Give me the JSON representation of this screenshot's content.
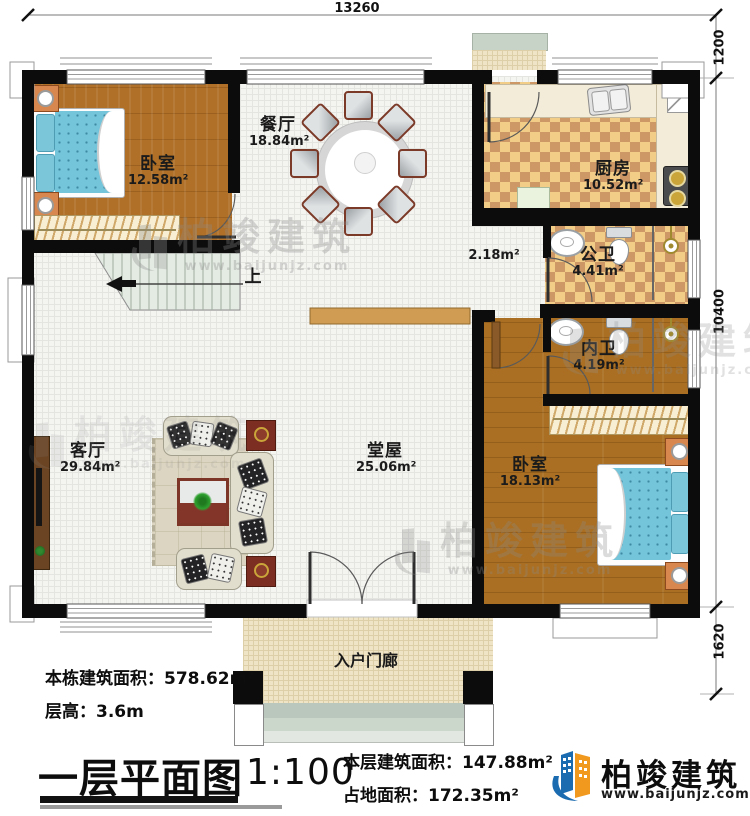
{
  "dimensions": {
    "top": "13260",
    "right_upper": "1200",
    "right_middle": "10400",
    "right_lower": "1620"
  },
  "rooms": {
    "bedroom_top": {
      "name": "卧室",
      "area": "12.58m²"
    },
    "dining": {
      "name": "餐厅",
      "area": "18.84m²"
    },
    "kitchen": {
      "name": "厨房",
      "area": "10.52m²"
    },
    "public_bath": {
      "name": "公卫",
      "area": "4.41m²"
    },
    "private_bath": {
      "name": "内卫",
      "area": "4.19m²"
    },
    "corridor": {
      "area": "2.18m²"
    },
    "living": {
      "name": "客厅",
      "area": "29.84m²"
    },
    "hall": {
      "name": "堂屋",
      "area": "25.06m²"
    },
    "bedroom_bottom": {
      "name": "卧室",
      "area": "18.13m²"
    },
    "porch": {
      "name": "入户门廊"
    },
    "stairs": {
      "direction": "上"
    }
  },
  "title_block": {
    "total_area": "本栋建筑面积：578.62m²",
    "floor_height": "层高：3.6m",
    "plan_title": "一层平面图",
    "scale": "1:100",
    "floor_area": "本层建筑面积：147.88m²",
    "footprint_area": "占地面积：172.35m²"
  },
  "brand": {
    "name": "柏竣建筑",
    "website": "www.baijunjz.com"
  },
  "watermark": {
    "name": "柏竣建筑",
    "website": "www.baijunjz.com"
  },
  "colors": {
    "accent_blue": "#1a6bb0",
    "accent_orange": "#f0991e",
    "wall": "#0c0c0c"
  }
}
